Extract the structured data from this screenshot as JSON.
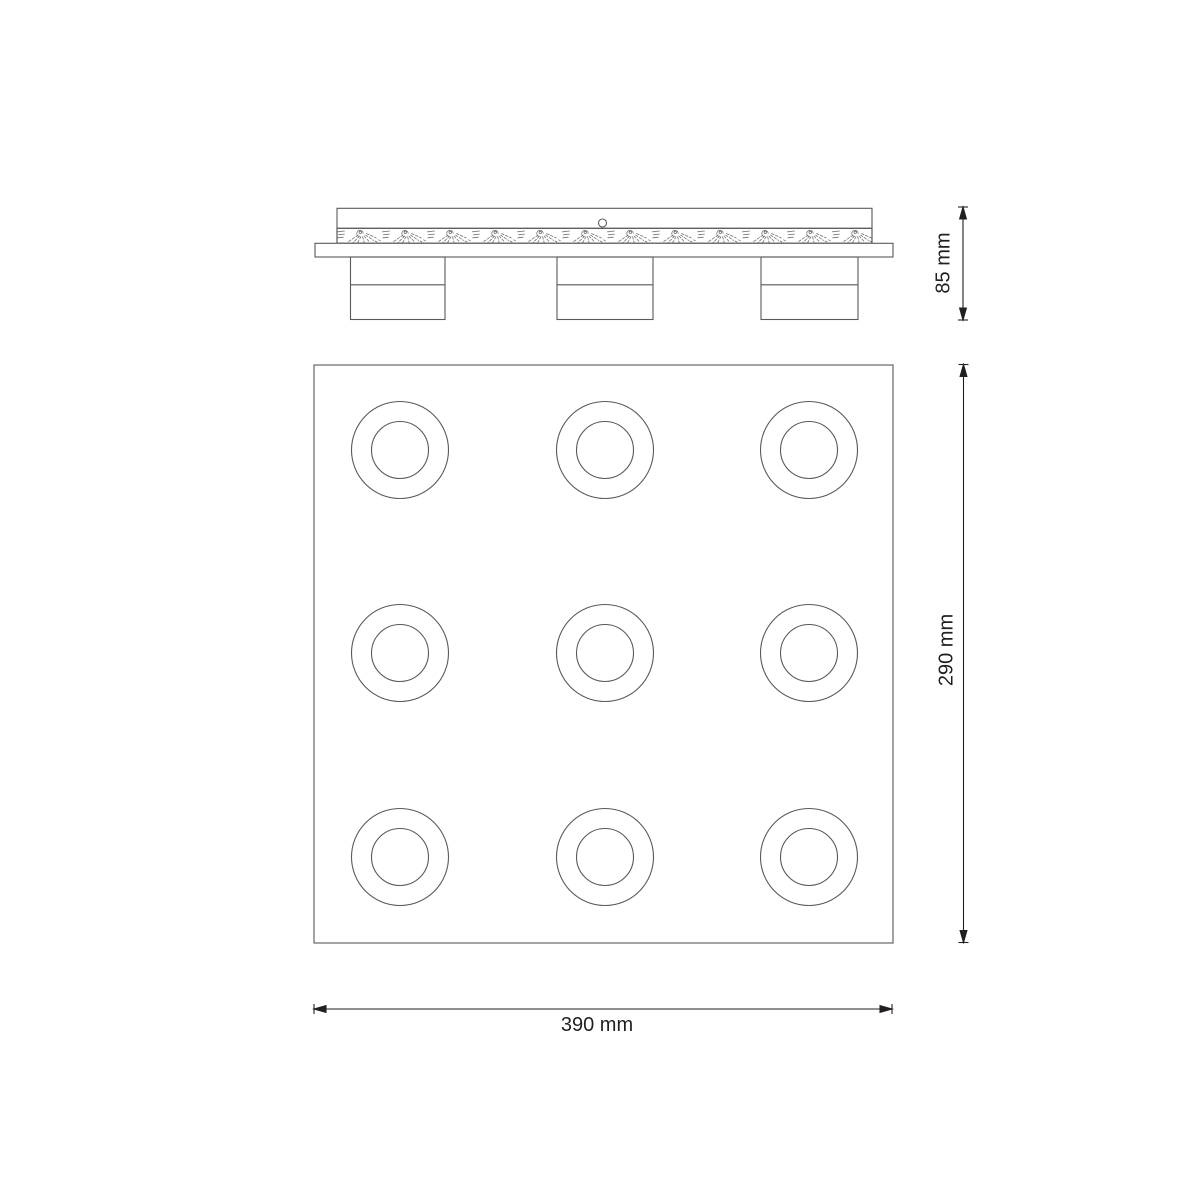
{
  "page": {
    "background_color": "#ffffff"
  },
  "drawing": {
    "line_color": "#58595b",
    "hatch_color": "#707070",
    "dimension_color": "#231f20",
    "side_view": {
      "lamp_head_count": 3,
      "height_dimension_label": "85 mm"
    },
    "plan_view": {
      "spot_rows": 3,
      "spot_cols": 3,
      "spot_col_centers": [
        400,
        605,
        809
      ],
      "spot_row_centers": [
        450,
        653,
        857
      ],
      "outer_ring_radius": 48.5,
      "inner_ring_radius": 28.5,
      "width_dimension_label": "390 mm",
      "height_dimension_label": "290 mm"
    }
  }
}
